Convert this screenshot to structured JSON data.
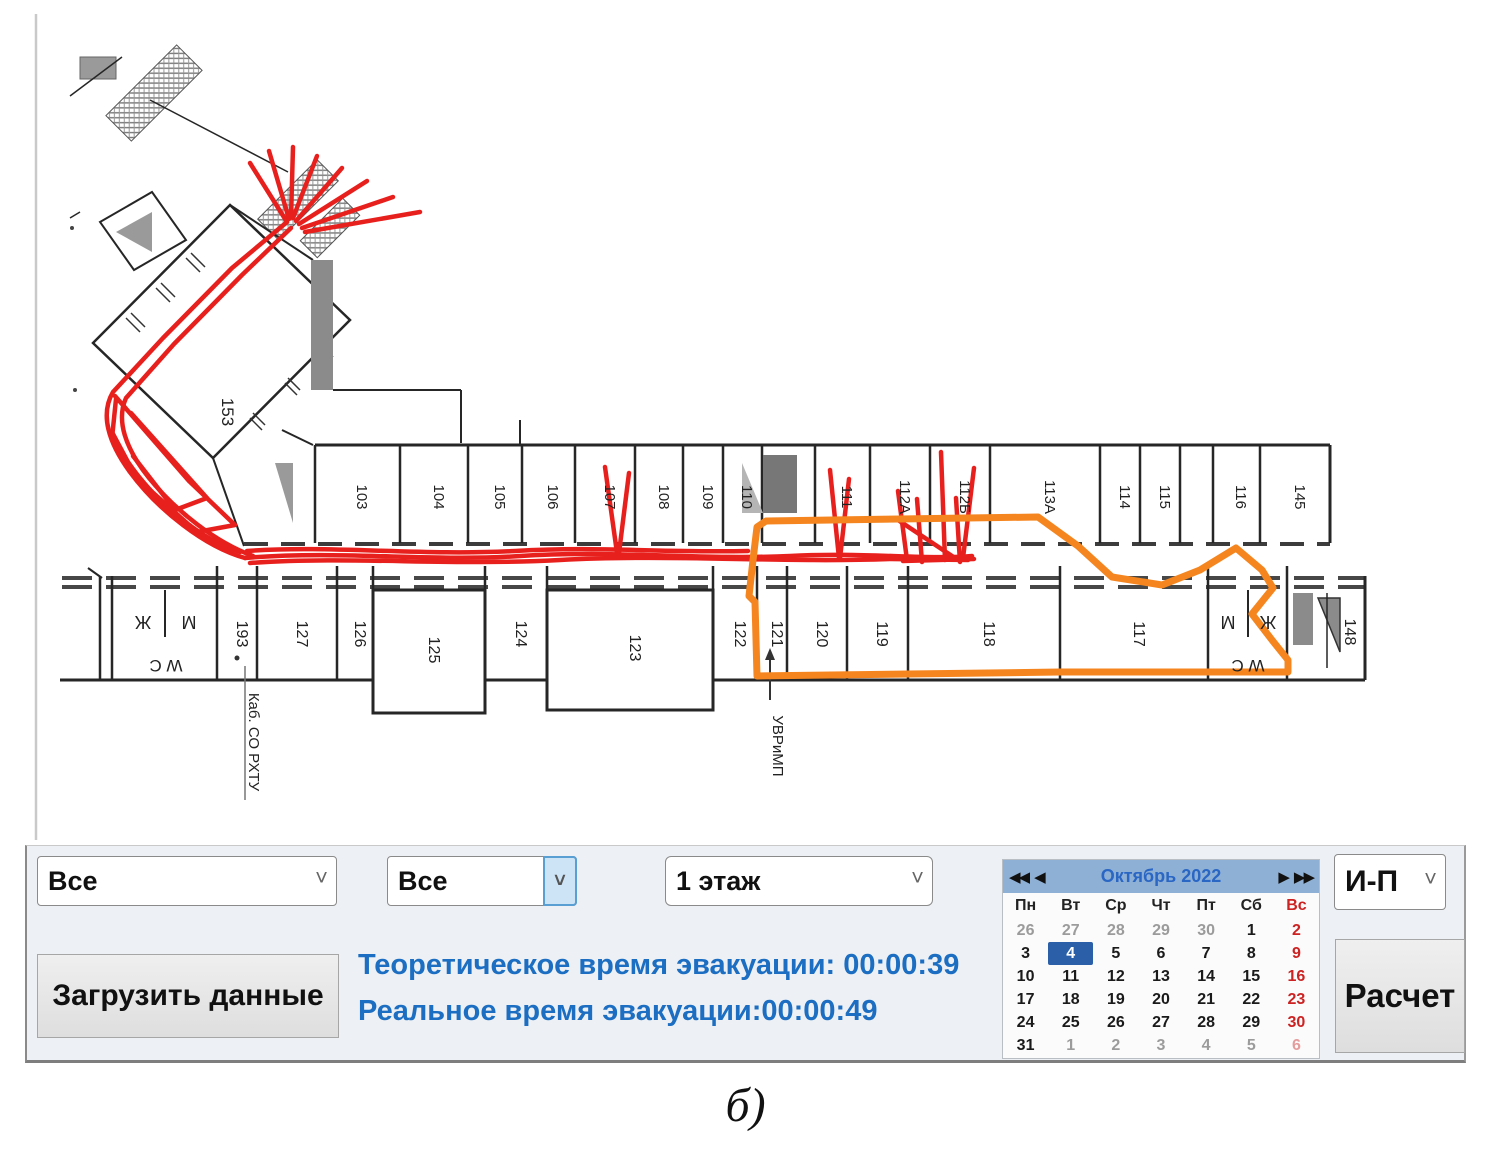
{
  "floor_plan": {
    "top_row_rooms": [
      "103",
      "104",
      "105",
      "106",
      "107",
      "108",
      "109",
      "110",
      "111",
      "112А",
      "112Б",
      "113А",
      "114",
      "115",
      "116",
      "145"
    ],
    "bottom_row_rooms": [
      "193",
      "127",
      "126",
      "125",
      "124",
      "123",
      "122",
      "121",
      "120",
      "119",
      "118",
      "117",
      "148"
    ],
    "diagonal_room": "153",
    "wc_left": {
      "left": "Ж",
      "right": "М",
      "bottom": "W C"
    },
    "wc_right": {
      "left": "М",
      "right": "Ж",
      "bottom": "W C"
    },
    "annotations": {
      "room193": "Каб. СО РХТУ",
      "room121": "УВРиМП"
    }
  },
  "controls": {
    "filter1": {
      "value": "Все"
    },
    "filter2": {
      "value": "Все"
    },
    "floor_select": {
      "value": "1 этаж"
    },
    "mode_select": {
      "value": "И-П"
    },
    "load_button": "Загрузить данные",
    "calc_button": "Расчет",
    "theoretical_time": "Теоретическое время эвакуации: 00:00:39",
    "real_time": "Реальное время эвакуации:00:00:49"
  },
  "calendar": {
    "title": "Октябрь 2022",
    "nav": {
      "fast_prev": "◀◀",
      "prev": "◀",
      "next": "▶",
      "fast_next": "▶▶"
    },
    "weekdays": [
      "Пн",
      "Вт",
      "Ср",
      "Чт",
      "Пт",
      "Сб",
      "Вс"
    ],
    "weeks": [
      [
        {
          "d": "26",
          "t": "out"
        },
        {
          "d": "27",
          "t": "out"
        },
        {
          "d": "28",
          "t": "out"
        },
        {
          "d": "29",
          "t": "out"
        },
        {
          "d": "30",
          "t": "out"
        },
        {
          "d": "1",
          "t": "day"
        },
        {
          "d": "2",
          "t": "sun"
        }
      ],
      [
        {
          "d": "3",
          "t": "day"
        },
        {
          "d": "4",
          "t": "sel"
        },
        {
          "d": "5",
          "t": "day"
        },
        {
          "d": "6",
          "t": "day"
        },
        {
          "d": "7",
          "t": "day"
        },
        {
          "d": "8",
          "t": "day"
        },
        {
          "d": "9",
          "t": "sun"
        }
      ],
      [
        {
          "d": "10",
          "t": "day"
        },
        {
          "d": "11",
          "t": "day"
        },
        {
          "d": "12",
          "t": "day"
        },
        {
          "d": "13",
          "t": "day"
        },
        {
          "d": "14",
          "t": "day"
        },
        {
          "d": "15",
          "t": "day"
        },
        {
          "d": "16",
          "t": "sun"
        }
      ],
      [
        {
          "d": "17",
          "t": "day"
        },
        {
          "d": "18",
          "t": "day"
        },
        {
          "d": "19",
          "t": "day"
        },
        {
          "d": "20",
          "t": "day"
        },
        {
          "d": "21",
          "t": "day"
        },
        {
          "d": "22",
          "t": "day"
        },
        {
          "d": "23",
          "t": "sun"
        }
      ],
      [
        {
          "d": "24",
          "t": "day"
        },
        {
          "d": "25",
          "t": "day"
        },
        {
          "d": "26",
          "t": "day"
        },
        {
          "d": "27",
          "t": "day"
        },
        {
          "d": "28",
          "t": "day"
        },
        {
          "d": "29",
          "t": "day"
        },
        {
          "d": "30",
          "t": "sun"
        }
      ],
      [
        {
          "d": "31",
          "t": "day"
        },
        {
          "d": "1",
          "t": "out"
        },
        {
          "d": "2",
          "t": "out"
        },
        {
          "d": "3",
          "t": "out"
        },
        {
          "d": "4",
          "t": "out"
        },
        {
          "d": "5",
          "t": "out"
        },
        {
          "d": "6",
          "t": "outsun"
        }
      ]
    ]
  },
  "colors": {
    "route_red": "#e8201d",
    "route_orange": "#f5861f",
    "accent_blue": "#1b6ec2",
    "calendar_header_bg": "#8fb0d5",
    "calendar_title": "#2a66c4",
    "selected_day_bg": "#2b5fa8",
    "sunday_red": "#cc2222"
  },
  "caption": "б)"
}
